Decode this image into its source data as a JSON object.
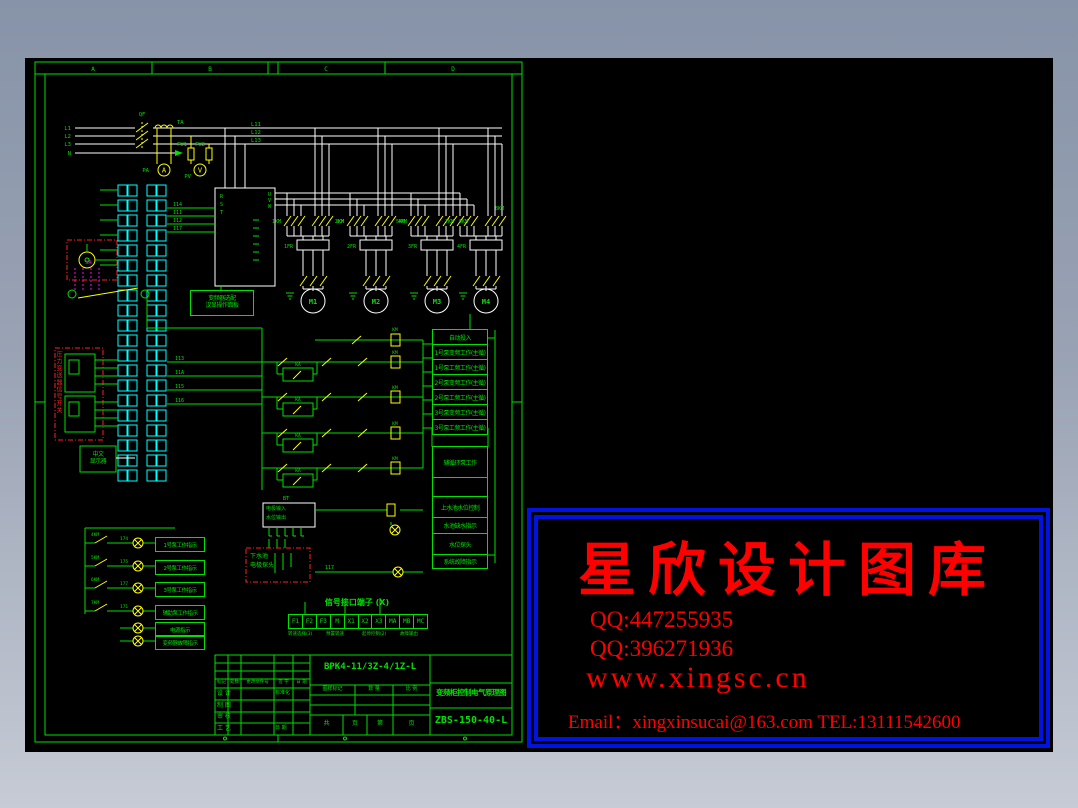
{
  "frame": {
    "zones": [
      "A",
      "B",
      "C",
      "D"
    ]
  },
  "power": {
    "l1": "L1",
    "l2": "L2",
    "l3": "L3",
    "n": "N",
    "qf": "QF",
    "ta": "TA",
    "pa": "PA",
    "pv": "PV",
    "fu1": "FU1",
    "fu2": "FU2",
    "bus": [
      "L11",
      "L12",
      "L13"
    ]
  },
  "inverter": {
    "r": "R",
    "s": "S",
    "t": "T",
    "u": "U",
    "v": "V",
    "w": "W",
    "note1": "变频器选配",
    "note2": "汉显操作面板"
  },
  "motors": {
    "labels": [
      "M1",
      "M2",
      "M3",
      "M4"
    ],
    "contactors": [
      "1KM",
      "2KM",
      "3KM",
      "4KM",
      "5KM",
      "6KM",
      "7KM",
      "8KM"
    ],
    "thermals": [
      "1FR",
      "2FR",
      "3FR",
      "4FR"
    ]
  },
  "selector": {
    "label": "SA"
  },
  "pressure": {
    "label": "压力变送器信号开关"
  },
  "display": {
    "line1": "中文",
    "line2": "显示器"
  },
  "electrode": {
    "bt": "BT",
    "left": "电极输入",
    "right": "水位输出",
    "tank1": "下水池",
    "tank2": "电极探头"
  },
  "ladder": {
    "ka": "KA",
    "km": "KM"
  },
  "wire_labels": {
    "w114": "114",
    "w111": "111",
    "w112": "112",
    "w117": "117",
    "w113": "113",
    "w11a": "11A",
    "w115": "115",
    "w116": "116",
    "w174": "174",
    "w175": "175",
    "w177": "177",
    "w171": "171"
  },
  "indicators": {
    "contacts": [
      "4KM",
      "5KM",
      "6KM",
      "7KM"
    ],
    "rows": [
      "1号泵工作指示",
      "2号泵工作指示",
      "3号泵工作指示",
      "辅助泵工作指示",
      "电源指示",
      "变频器故障指示"
    ]
  },
  "status": {
    "rows_a": [
      "自动投入",
      "1号泵变频工作(主循)",
      "1号泵工频工作(主循)",
      "2号泵变频工作(主循)",
      "2号泵工频工作(主循)",
      "3号泵变频工作(主循)",
      "3号泵工频工作(主循)"
    ],
    "rows_b": [
      "辅循环泵工作",
      "",
      "上水池水位控制",
      "水池缺水指示",
      "水位探头",
      "系统故障指示"
    ]
  },
  "signal_table": {
    "title": "信号接口端子 (X)",
    "cells": [
      "F1",
      "F2",
      "F3",
      "M",
      "X1",
      "X2",
      "X3",
      "MA",
      "MB",
      "MC"
    ],
    "notes": [
      "转速选择(3)",
      "预置转速",
      "起停控制(2)",
      "故障输出"
    ]
  },
  "title_block": {
    "model": "BPK4-11/3Z-4/1Z-L",
    "title": "变频柜控制电气原理图",
    "number": "ZBS-150-40-L",
    "rev_header": [
      "标记",
      "处数",
      "更改文件号",
      "签 字",
      "日 期"
    ],
    "rows": [
      "设 计",
      "制 图",
      "审 核",
      "工 艺"
    ],
    "std": "标准化",
    "date": "日 期",
    "mid": [
      "图样标记",
      "数 量",
      "比 例"
    ],
    "sheet": [
      "共",
      "页",
      "第",
      "页"
    ]
  },
  "watermark": {
    "title": "星欣设计图库",
    "qq1": "QQ:447255935",
    "qq2": "QQ:396271936",
    "site": "www.xingsc.cn",
    "contact": "Email：xingxinsucai@163.com  TEL:13111542600",
    "accent": "#ff0000",
    "border": "#0013e0"
  }
}
